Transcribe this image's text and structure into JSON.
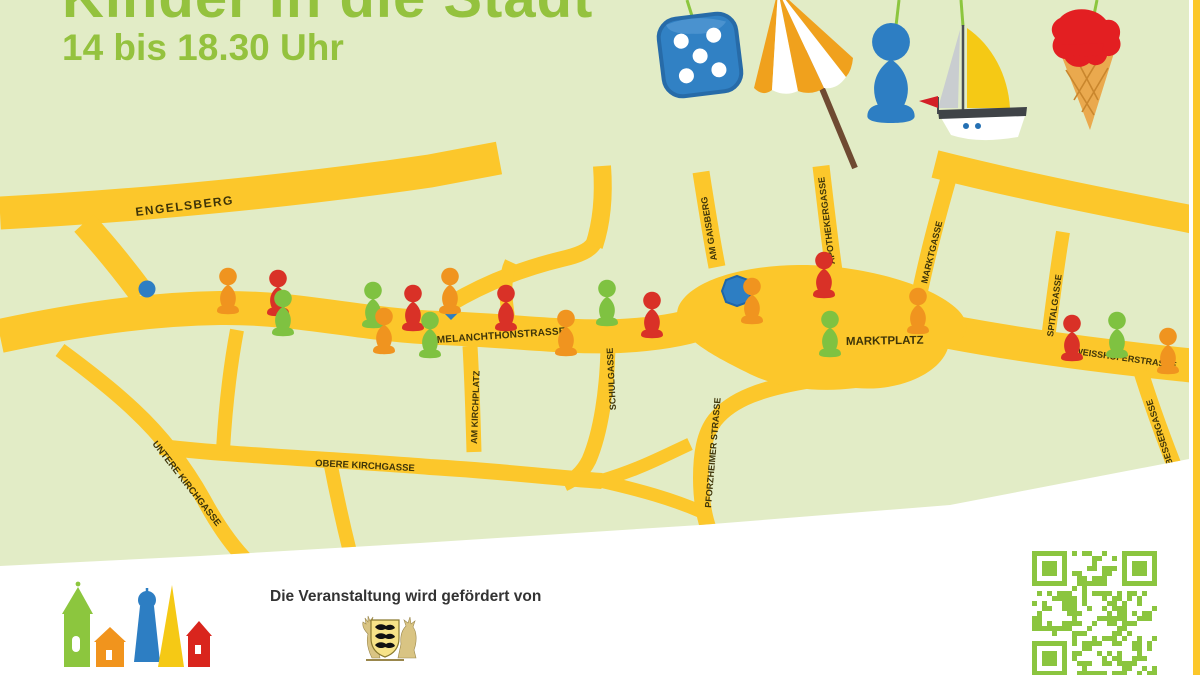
{
  "poster": {
    "title": "Kinder in die Stadt",
    "subtitle": "14 bis 18.30 Uhr"
  },
  "palette": {
    "background_green": "#e2ecc6",
    "road_yellow": "#fcc72b",
    "title_green": "#94c23e",
    "street_label_dark": "#3e3408",
    "pawn_red": "#d93127",
    "pawn_green": "#7fc241",
    "pawn_orange": "#f0941f",
    "marker_blue": "#2d7ec3",
    "qr_green": "#8bc53f",
    "border_stripe_yellow": "#fcc72b"
  },
  "hanging_toys": [
    "blue die",
    "beach umbrella",
    "blue game pawn",
    "sailboat",
    "ice cream cone"
  ],
  "map": {
    "streets": [
      {
        "id": "engelsberg",
        "label": "ENGELSBERG"
      },
      {
        "id": "melanchthonstrasse",
        "label": "MELANCHTHONSTRASSE"
      },
      {
        "id": "am-kirchplatz",
        "label": "AM KIRCHPLATZ"
      },
      {
        "id": "schulgasse",
        "label": "SCHULGASSE"
      },
      {
        "id": "obere-kirchgasse",
        "label": "OBERE KIRCHGASSE"
      },
      {
        "id": "untere-kirchgasse",
        "label": "UNTERE KIRCHGASSE"
      },
      {
        "id": "pforzheimer-strasse",
        "label": "PFORZHEIMER STRASSE"
      },
      {
        "id": "am-gaisberg",
        "label": "AM GAISBERG"
      },
      {
        "id": "apothekergasse",
        "label": "APOTHEKERGASSE"
      },
      {
        "id": "marktgasse",
        "label": "MARKTGASSE"
      },
      {
        "id": "marktplatz",
        "label": "MARKTPLATZ"
      },
      {
        "id": "spitalgasse",
        "label": "SPITALGASSE"
      },
      {
        "id": "weisshoferstrasse",
        "label": "WEISSHOFERSTRASSE"
      },
      {
        "id": "bessergasse",
        "label": "BESSERGASSE"
      }
    ],
    "pawns": [
      {
        "color": "orange",
        "x": 228,
        "y": 310
      },
      {
        "color": "red",
        "x": 278,
        "y": 312
      },
      {
        "color": "green",
        "x": 283,
        "y": 332
      },
      {
        "color": "green",
        "x": 373,
        "y": 324
      },
      {
        "color": "orange",
        "x": 384,
        "y": 350
      },
      {
        "color": "red",
        "x": 413,
        "y": 327
      },
      {
        "color": "green",
        "x": 430,
        "y": 354
      },
      {
        "color": "orange",
        "x": 450,
        "y": 310
      },
      {
        "color": "red",
        "x": 506,
        "y": 327
      },
      {
        "color": "orange",
        "x": 566,
        "y": 352
      },
      {
        "color": "green",
        "x": 607,
        "y": 322
      },
      {
        "color": "red",
        "x": 652,
        "y": 334
      },
      {
        "color": "orange",
        "x": 752,
        "y": 320
      },
      {
        "color": "red",
        "x": 824,
        "y": 294
      },
      {
        "color": "green",
        "x": 830,
        "y": 353
      },
      {
        "color": "orange",
        "x": 918,
        "y": 330
      },
      {
        "color": "red",
        "x": 1072,
        "y": 357
      },
      {
        "color": "green",
        "x": 1117,
        "y": 354
      },
      {
        "color": "orange",
        "x": 1168,
        "y": 370
      }
    ],
    "markers": [
      {
        "shape": "circle",
        "x": 147,
        "y": 289
      },
      {
        "shape": "diamond",
        "x": 451,
        "y": 312
      },
      {
        "shape": "octagon",
        "x": 737,
        "y": 291
      }
    ]
  },
  "footer": {
    "sponsor_text": "Die Veranstaltung wird gefördert von",
    "sponsor_logo": "Baden-Württemberg coat of arms",
    "qr_label": "QR code"
  }
}
